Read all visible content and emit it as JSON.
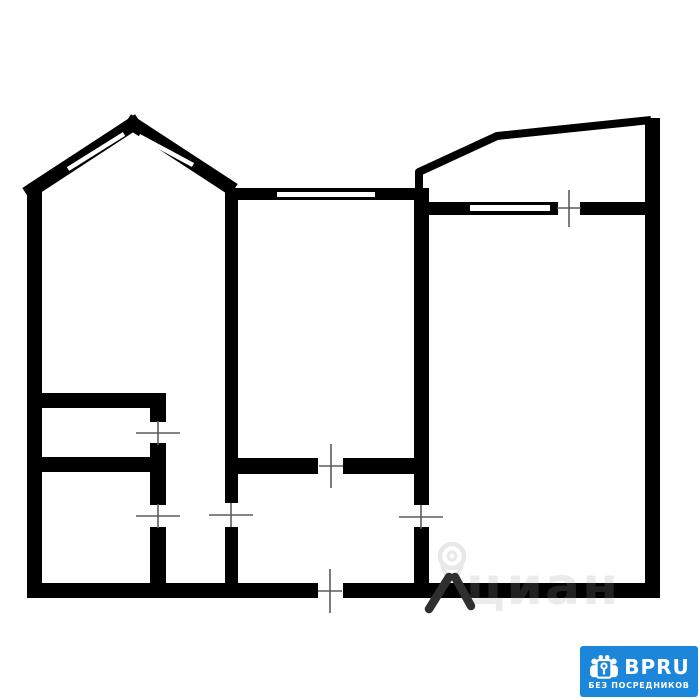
{
  "plan": {
    "background": "#ffffff",
    "wall_color": "#000000",
    "door_mark_color": "#5c5c5c",
    "window_color": "#ffffff"
  },
  "watermark": {
    "text": "циан",
    "pin_icon": "map-pin-walking-icon",
    "light_color": "#e8e8e8",
    "overlay_color": "rgba(255,255,255,0.13)",
    "dark_color": "#2f2f2f"
  },
  "badge": {
    "brand": "BPRU",
    "tagline": "БЕЗ ПОСРЕДНИКОВ",
    "bg_color": "#1b86da",
    "text_color": "#ffffff",
    "icon": "people-group-key-icon"
  }
}
